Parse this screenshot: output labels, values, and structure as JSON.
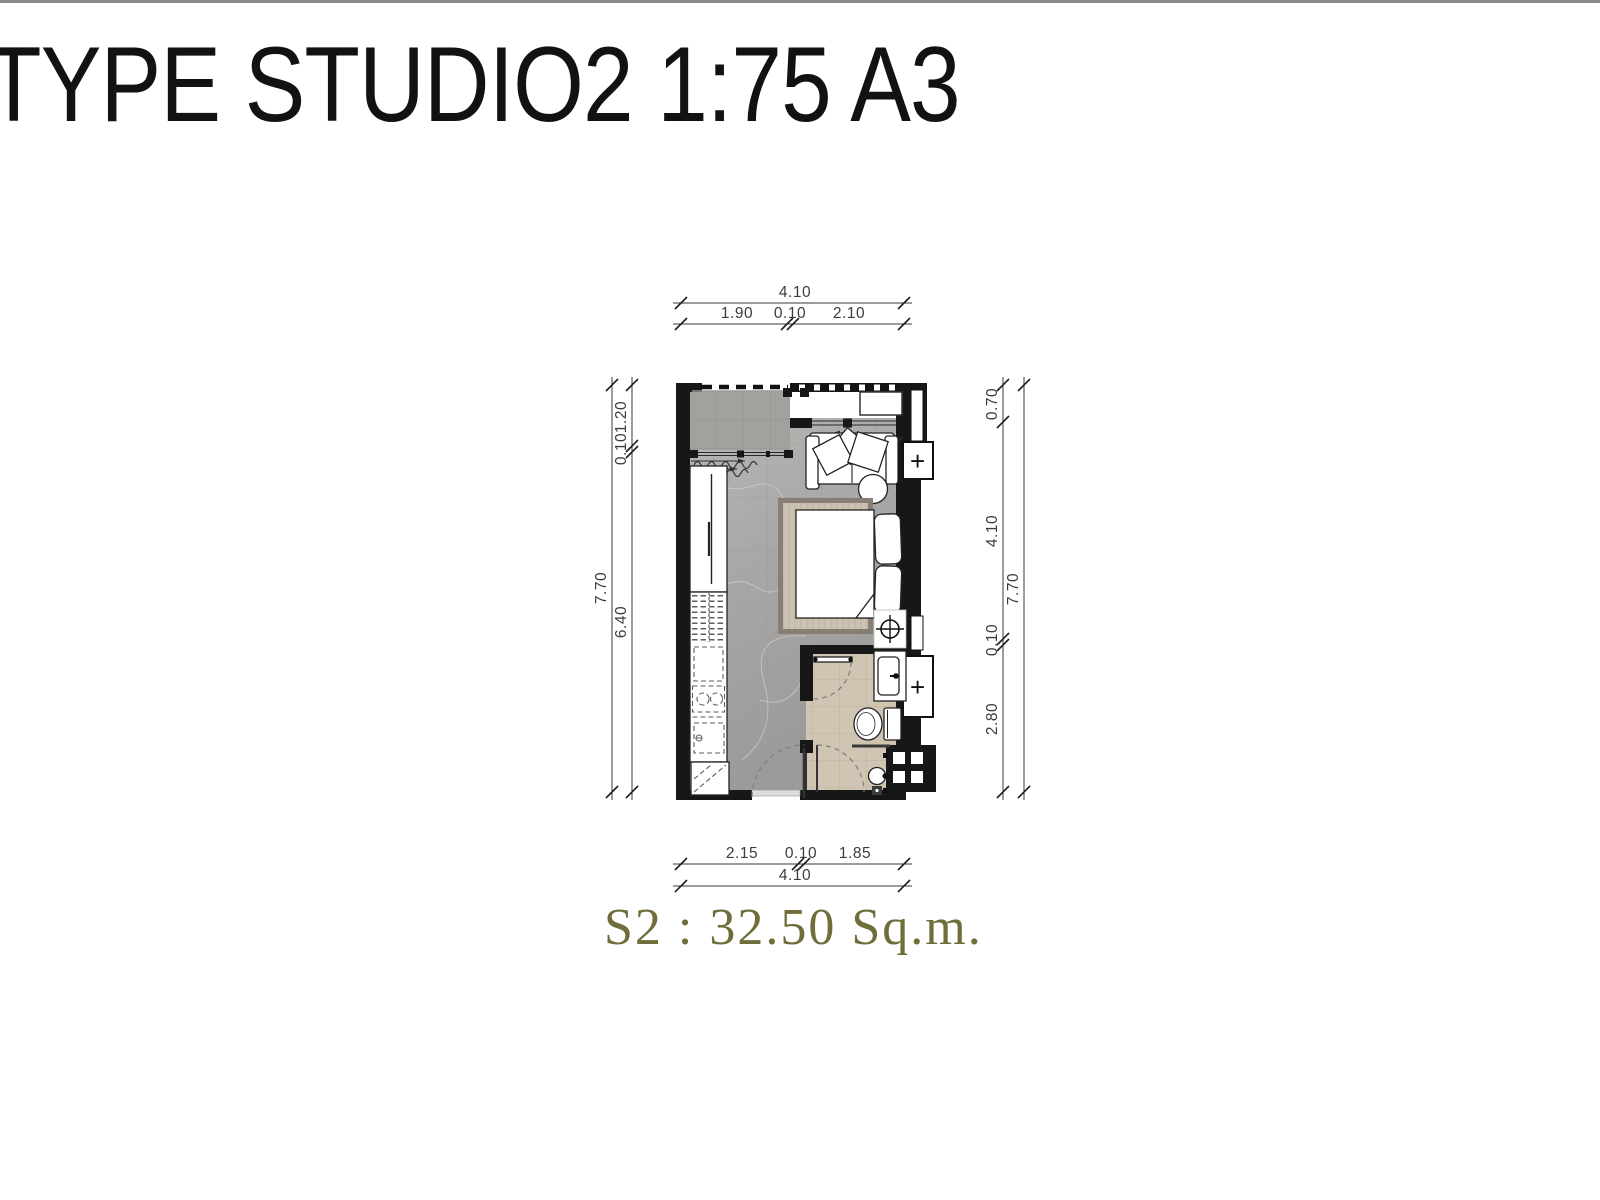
{
  "page": {
    "title": "TYPE STUDIO2 1:75 A3",
    "area_label": "S2 : 32.50 Sq.m."
  },
  "plan": {
    "dims": {
      "top": {
        "total": "4.10",
        "segments": [
          "1.90",
          "0.10",
          "2.10"
        ]
      },
      "bottom": {
        "total": "4.10",
        "segments": [
          "2.15",
          "0.10",
          "1.85"
        ]
      },
      "left": {
        "total": "7.70",
        "segments": [
          "1.20",
          "0.10",
          "6.40"
        ]
      },
      "right": {
        "total": "7.70",
        "segments": [
          "0.70",
          "4.10",
          "0.10",
          "2.80"
        ]
      }
    },
    "symbols": {
      "plus": "+"
    },
    "colors": {
      "area_label": "#6f6e3a",
      "wall": "#171717",
      "floor_living": "#b0afad",
      "floor_balcony": "#a2a19d",
      "floor_bathroom": "#cfc5b2",
      "rug_border": "#877f73",
      "rug_field": "#cbc2b3"
    }
  }
}
